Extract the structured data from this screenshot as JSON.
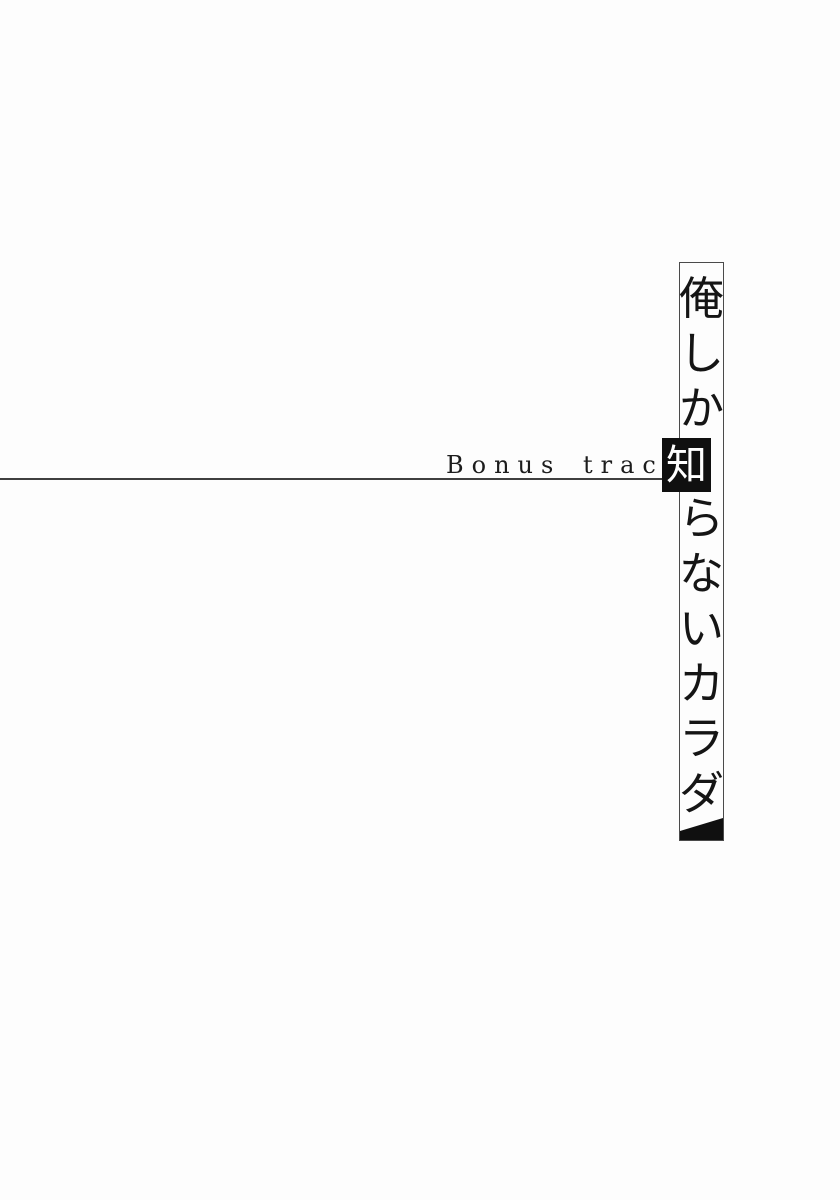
{
  "page": {
    "bonus_label": "Bonus track",
    "title": "俺しか知らないカラダ",
    "title_chars": [
      "俺",
      "し",
      "か",
      "知",
      "ら",
      "な",
      "い",
      "カ",
      "ラ",
      "ダ"
    ],
    "highlight_char": "知",
    "colors": {
      "background": "#fdfdfd",
      "ink": "#151515",
      "rule": "#3f3f3f",
      "column_border": "#4a4a4a",
      "highlight_background": "#101010",
      "highlight_text": "#ffffff"
    }
  }
}
